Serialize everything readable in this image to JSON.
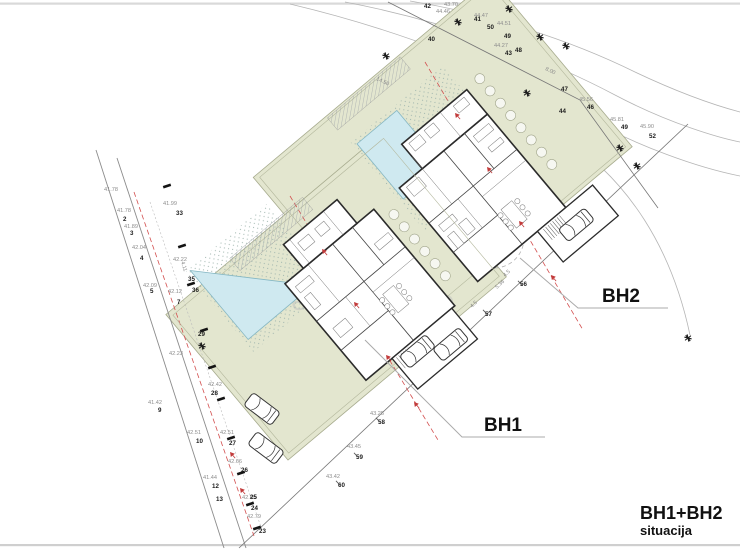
{
  "meta": {
    "title": "BH1+BH2",
    "subtitle": "situacija"
  },
  "labels": {
    "bh1": "BH1",
    "bh2": "BH2"
  },
  "watermark": "nekretnine",
  "colors": {
    "site_green": "#e3e6cf",
    "pool_blue": "#cfe9f0",
    "red_setback": "#d34f4f",
    "contour_gray": "#b5b5b5"
  },
  "plan": {
    "elevations": [
      {
        "x": 104,
        "y": 191,
        "t": "41.78"
      },
      {
        "x": 117,
        "y": 212,
        "t": "41.78"
      },
      {
        "x": 124,
        "y": 228,
        "t": "41.89"
      },
      {
        "x": 132,
        "y": 249,
        "t": "42.04"
      },
      {
        "x": 143,
        "y": 287,
        "t": "42.09"
      },
      {
        "x": 168,
        "y": 293,
        "t": "42.12"
      },
      {
        "x": 163,
        "y": 205,
        "t": "41.99"
      },
      {
        "x": 173,
        "y": 261,
        "t": "42.22"
      },
      {
        "x": 169,
        "y": 355,
        "t": "42.23"
      },
      {
        "x": 208,
        "y": 386,
        "t": "42.42"
      },
      {
        "x": 148,
        "y": 404,
        "t": "41.42"
      },
      {
        "x": 187,
        "y": 434,
        "t": "42.51"
      },
      {
        "x": 220,
        "y": 434,
        "t": "42.51"
      },
      {
        "x": 228,
        "y": 463,
        "t": "42.66"
      },
      {
        "x": 203,
        "y": 479,
        "t": "41.44"
      },
      {
        "x": 242,
        "y": 499,
        "t": "42.65"
      },
      {
        "x": 247,
        "y": 518,
        "t": "42.79"
      },
      {
        "x": 347,
        "y": 448,
        "t": "43.45"
      },
      {
        "x": 326,
        "y": 478,
        "t": "43.42"
      },
      {
        "x": 370,
        "y": 415,
        "t": "43.25"
      },
      {
        "x": 444,
        "y": 6,
        "t": "43.70"
      },
      {
        "x": 436,
        "y": 13,
        "t": "44.46"
      },
      {
        "x": 474,
        "y": 17,
        "t": "44.47"
      },
      {
        "x": 497,
        "y": 25,
        "t": "44.51"
      },
      {
        "x": 494,
        "y": 47,
        "t": "44.27"
      },
      {
        "x": 579,
        "y": 101,
        "t": "45.56"
      },
      {
        "x": 610,
        "y": 121,
        "t": "45.81"
      },
      {
        "x": 640,
        "y": 128,
        "t": "45.90"
      }
    ],
    "point_numbers": [
      {
        "x": 123,
        "y": 221,
        "t": "2"
      },
      {
        "x": 130,
        "y": 235,
        "t": "3"
      },
      {
        "x": 140,
        "y": 260,
        "t": "4"
      },
      {
        "x": 150,
        "y": 293,
        "t": "5"
      },
      {
        "x": 177,
        "y": 304,
        "t": "7"
      },
      {
        "x": 158,
        "y": 412,
        "t": "9"
      },
      {
        "x": 196,
        "y": 443,
        "t": "10"
      },
      {
        "x": 212,
        "y": 488,
        "t": "12"
      },
      {
        "x": 216,
        "y": 501,
        "t": "13"
      },
      {
        "x": 259,
        "y": 533,
        "t": "23"
      },
      {
        "x": 251,
        "y": 510,
        "t": "24"
      },
      {
        "x": 250,
        "y": 499,
        "t": "25"
      },
      {
        "x": 241,
        "y": 472,
        "t": "26"
      },
      {
        "x": 229,
        "y": 445,
        "t": "27"
      },
      {
        "x": 211,
        "y": 395,
        "t": "28"
      },
      {
        "x": 198,
        "y": 336,
        "t": "29"
      },
      {
        "x": 176,
        "y": 215,
        "t": "33"
      },
      {
        "x": 188,
        "y": 281,
        "t": "35"
      },
      {
        "x": 192,
        "y": 292,
        "t": "36"
      },
      {
        "x": 428,
        "y": 41,
        "t": "40"
      },
      {
        "x": 474,
        "y": 21,
        "t": "41"
      },
      {
        "x": 424,
        "y": 8,
        "t": "42"
      },
      {
        "x": 505,
        "y": 55,
        "t": "43"
      },
      {
        "x": 559,
        "y": 113,
        "t": "44"
      },
      {
        "x": 587,
        "y": 109,
        "t": "46"
      },
      {
        "x": 561,
        "y": 91,
        "t": "47"
      },
      {
        "x": 515,
        "y": 52,
        "t": "48"
      },
      {
        "x": 504,
        "y": 38,
        "t": "49"
      },
      {
        "x": 621,
        "y": 129,
        "t": "49"
      },
      {
        "x": 487,
        "y": 29,
        "t": "50"
      },
      {
        "x": 649,
        "y": 138,
        "t": "52"
      },
      {
        "x": 520,
        "y": 286,
        "t": "56"
      },
      {
        "x": 485,
        "y": 316,
        "t": "57"
      },
      {
        "x": 378,
        "y": 424,
        "t": "58"
      },
      {
        "x": 356,
        "y": 459,
        "t": "59"
      },
      {
        "x": 338,
        "y": 487,
        "t": "60"
      }
    ],
    "dimensions": [
      {
        "x": 181,
        "y": 262,
        "r": 73,
        "t": "4.11"
      },
      {
        "x": 497,
        "y": 289,
        "r": -43,
        "t": "5.36"
      },
      {
        "x": 505,
        "y": 277,
        "r": -43,
        "t": "4.5"
      },
      {
        "x": 472,
        "y": 308,
        "r": -43,
        "t": "4.5"
      },
      {
        "x": 376,
        "y": 80,
        "r": 25,
        "t": "14.50"
      },
      {
        "x": 545,
        "y": 70,
        "r": 25,
        "t": "8.00"
      }
    ],
    "trees": [
      {
        "x": 386,
        "y": 56
      },
      {
        "x": 458,
        "y": 22
      },
      {
        "x": 509,
        "y": 9
      },
      {
        "x": 540,
        "y": 37
      },
      {
        "x": 566,
        "y": 46
      },
      {
        "x": 527,
        "y": 93
      },
      {
        "x": 620,
        "y": 148
      },
      {
        "x": 637,
        "y": 166
      },
      {
        "x": 688,
        "y": 338
      },
      {
        "x": 202,
        "y": 346
      }
    ],
    "benchmarks": [
      {
        "x": 455,
        "y": 113
      },
      {
        "x": 487,
        "y": 167
      },
      {
        "x": 519,
        "y": 221
      },
      {
        "x": 551,
        "y": 275
      },
      {
        "x": 322,
        "y": 249
      },
      {
        "x": 354,
        "y": 302
      },
      {
        "x": 386,
        "y": 355
      },
      {
        "x": 414,
        "y": 402
      },
      {
        "x": 230,
        "y": 452
      },
      {
        "x": 240,
        "y": 488
      }
    ],
    "survey_marks": [
      {
        "x": 167,
        "y": 186
      },
      {
        "x": 182,
        "y": 246
      },
      {
        "x": 191,
        "y": 284
      },
      {
        "x": 204,
        "y": 330
      },
      {
        "x": 212,
        "y": 367
      },
      {
        "x": 221,
        "y": 399
      },
      {
        "x": 231,
        "y": 438
      },
      {
        "x": 241,
        "y": 473
      },
      {
        "x": 250,
        "y": 504
      },
      {
        "x": 257,
        "y": 528
      }
    ],
    "fence_ticks": [
      {
        "x": 520,
        "y": 283
      },
      {
        "x": 485,
        "y": 312
      },
      {
        "x": 378,
        "y": 420
      },
      {
        "x": 356,
        "y": 455
      },
      {
        "x": 338,
        "y": 483
      }
    ]
  }
}
